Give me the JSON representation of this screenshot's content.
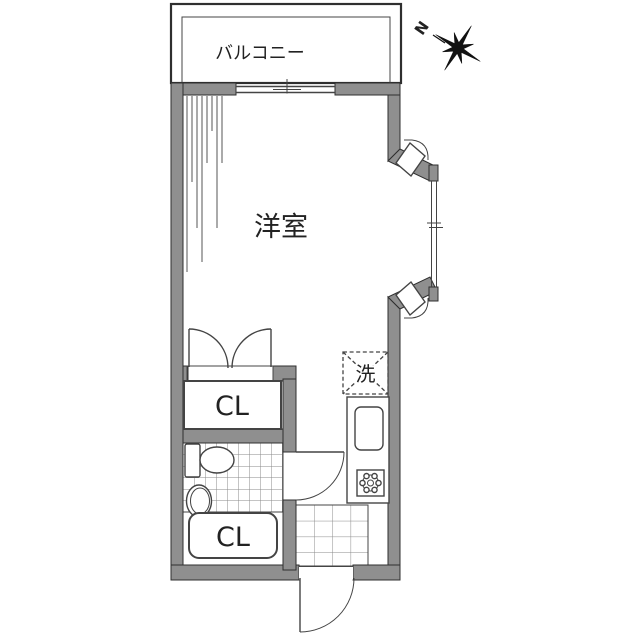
{
  "labels": {
    "balcony": "バルコニー",
    "western_room": "洋室",
    "closet_upper": "CL",
    "closet_lower": "CL",
    "laundry": "洗",
    "compass_north": "N"
  },
  "colors": {
    "background": "#ffffff",
    "wall_fill": "#8f8f8f",
    "wall_outline": "#2f2f2f",
    "line": "#444444",
    "tile_grid": "#8a8a8a",
    "text": "#222222"
  }
}
